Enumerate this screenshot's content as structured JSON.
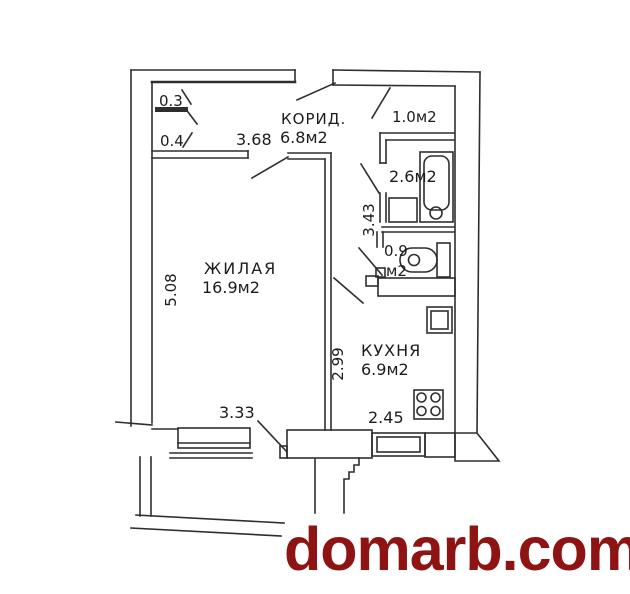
{
  "watermark": {
    "text": "domarb.com",
    "color": "#8e1414"
  },
  "plan": {
    "line_color": "#2e2e2e",
    "rooms": {
      "living": {
        "name": "ЖИЛАЯ",
        "area": "16.9м2"
      },
      "corridor": {
        "name": "КОРИД.",
        "area": "6.8м2"
      },
      "kitchen": {
        "name": "КУХНЯ",
        "area": "6.9м2"
      },
      "closet": {
        "area": "1.0м2"
      },
      "bathroom": {
        "area": "2.6м2"
      },
      "wc": {
        "area_line1": "0.9",
        "area_line2": "м2"
      },
      "niche_upper": {
        "area": "0.3"
      },
      "niche_lower": {
        "area": "0.4"
      }
    },
    "dimensions": {
      "corridor_width": "3.68",
      "living_height": "5.08",
      "living_width": "3.33",
      "hall_length": "3.43",
      "kitchen_length": "2.99",
      "kitchen_width": "2.45"
    }
  }
}
